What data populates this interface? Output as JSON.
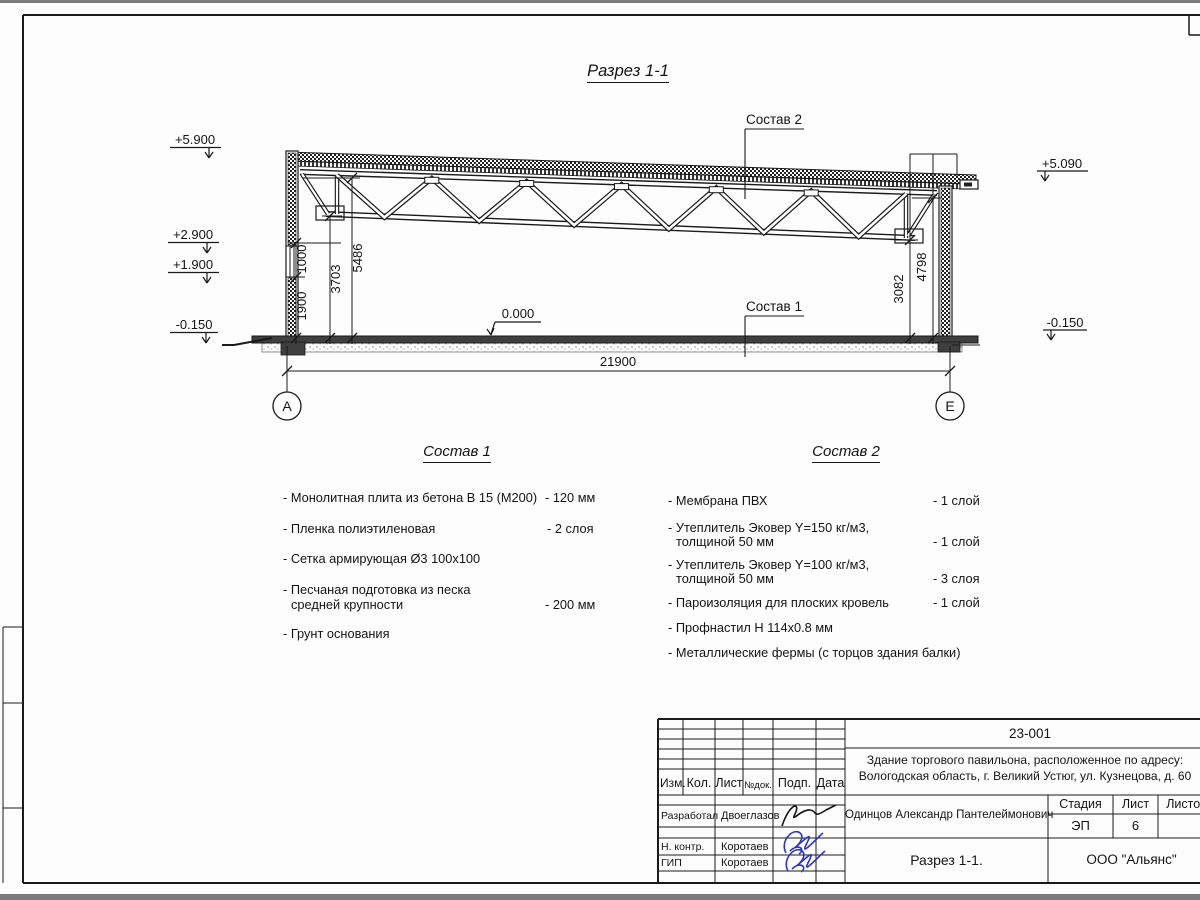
{
  "page_title": "Разрез 1-1",
  "colors": {
    "signature_blue": "#2b35c8",
    "line_black": "#1a1a1a"
  },
  "drawing": {
    "elev": {
      "left1": "+5.900",
      "left2": "+2.900",
      "left3": "+1.900",
      "left4": "-0.150",
      "right1": "+5.090",
      "right2": "-0.150",
      "zero": "0.000"
    },
    "dims": {
      "d1900": "1900",
      "d1000": "1000",
      "d3703": "3703",
      "d5486": "5486",
      "d3082": "3082",
      "d4798": "4798",
      "d21900": "21900"
    },
    "axes": {
      "a": "А",
      "e": "Е"
    },
    "callouts": {
      "c1": "Состав 1",
      "c2": "Состав 2"
    }
  },
  "lists": {
    "s1": {
      "heading": "Состав 1",
      "items": [
        {
          "l1": "- Монолитная плита из бетона В 15 (М200)",
          "l2": "",
          "val": "- 120 мм"
        },
        {
          "l1": "- Пленка полиэтиленовая",
          "l2": "",
          "val": "-  2 слоя"
        },
        {
          "l1": "- Сетка армирующая Ø3 100х100",
          "l2": "",
          "val": ""
        },
        {
          "l1": "- Песчаная подготовка из песка",
          "l2": "средней крупности",
          "val": "- 200 мм"
        },
        {
          "l1": "- Грунт основания",
          "l2": "",
          "val": ""
        }
      ]
    },
    "s2": {
      "heading": "Состав 2",
      "items": [
        {
          "l1": "- Мембрана ПВХ",
          "l2": "",
          "val": "- 1 слой"
        },
        {
          "l1": "- Утеплитель Эковер Y=150 кг/м3,",
          "l2": "толщиной 50 мм",
          "val": "- 1 слой"
        },
        {
          "l1": "- Утеплитель Эковер Y=100 кг/м3,",
          "l2": "толщиной 50 мм",
          "val": "- 3 слоя"
        },
        {
          "l1": "- Пароизоляция для плоских кровель",
          "l2": "",
          "val": "- 1 слой"
        },
        {
          "l1": "- Профнастил Н 114х0.8 мм",
          "l2": "",
          "val": ""
        },
        {
          "l1": "- Металлические фермы (с торцов здания балки)",
          "l2": "",
          "val": ""
        }
      ]
    }
  },
  "titleblock": {
    "doc_number": "23-001",
    "project_line1": "Здание торгового павильона, расположенное по адресу:",
    "project_line2": "Вологодская область, г. Великий Устюг, ул. Кузнецова, д. 60",
    "cols": {
      "izm": "Изм.",
      "kol": "Кол.",
      "list": "Лист",
      "ndok": "№док.",
      "podp": "Подп.",
      "data": "Дата"
    },
    "roles": {
      "r1": "Разработал",
      "r2": "Н. контр.",
      "r3": "ГИП"
    },
    "names": {
      "n1": "Двоеглазов",
      "n2": "Коротаев",
      "n3": "Коротаев"
    },
    "approver": "Одинцов Александр Пантелеймонович",
    "stage_label": "Стадия",
    "sheet_label": "Лист",
    "sheets_label": "Листов",
    "stage": "ЭП",
    "sheet_num": "6",
    "sheets_total": "",
    "drawing_name": "Разрез 1-1.",
    "company": "ООО \"Альянс\""
  }
}
